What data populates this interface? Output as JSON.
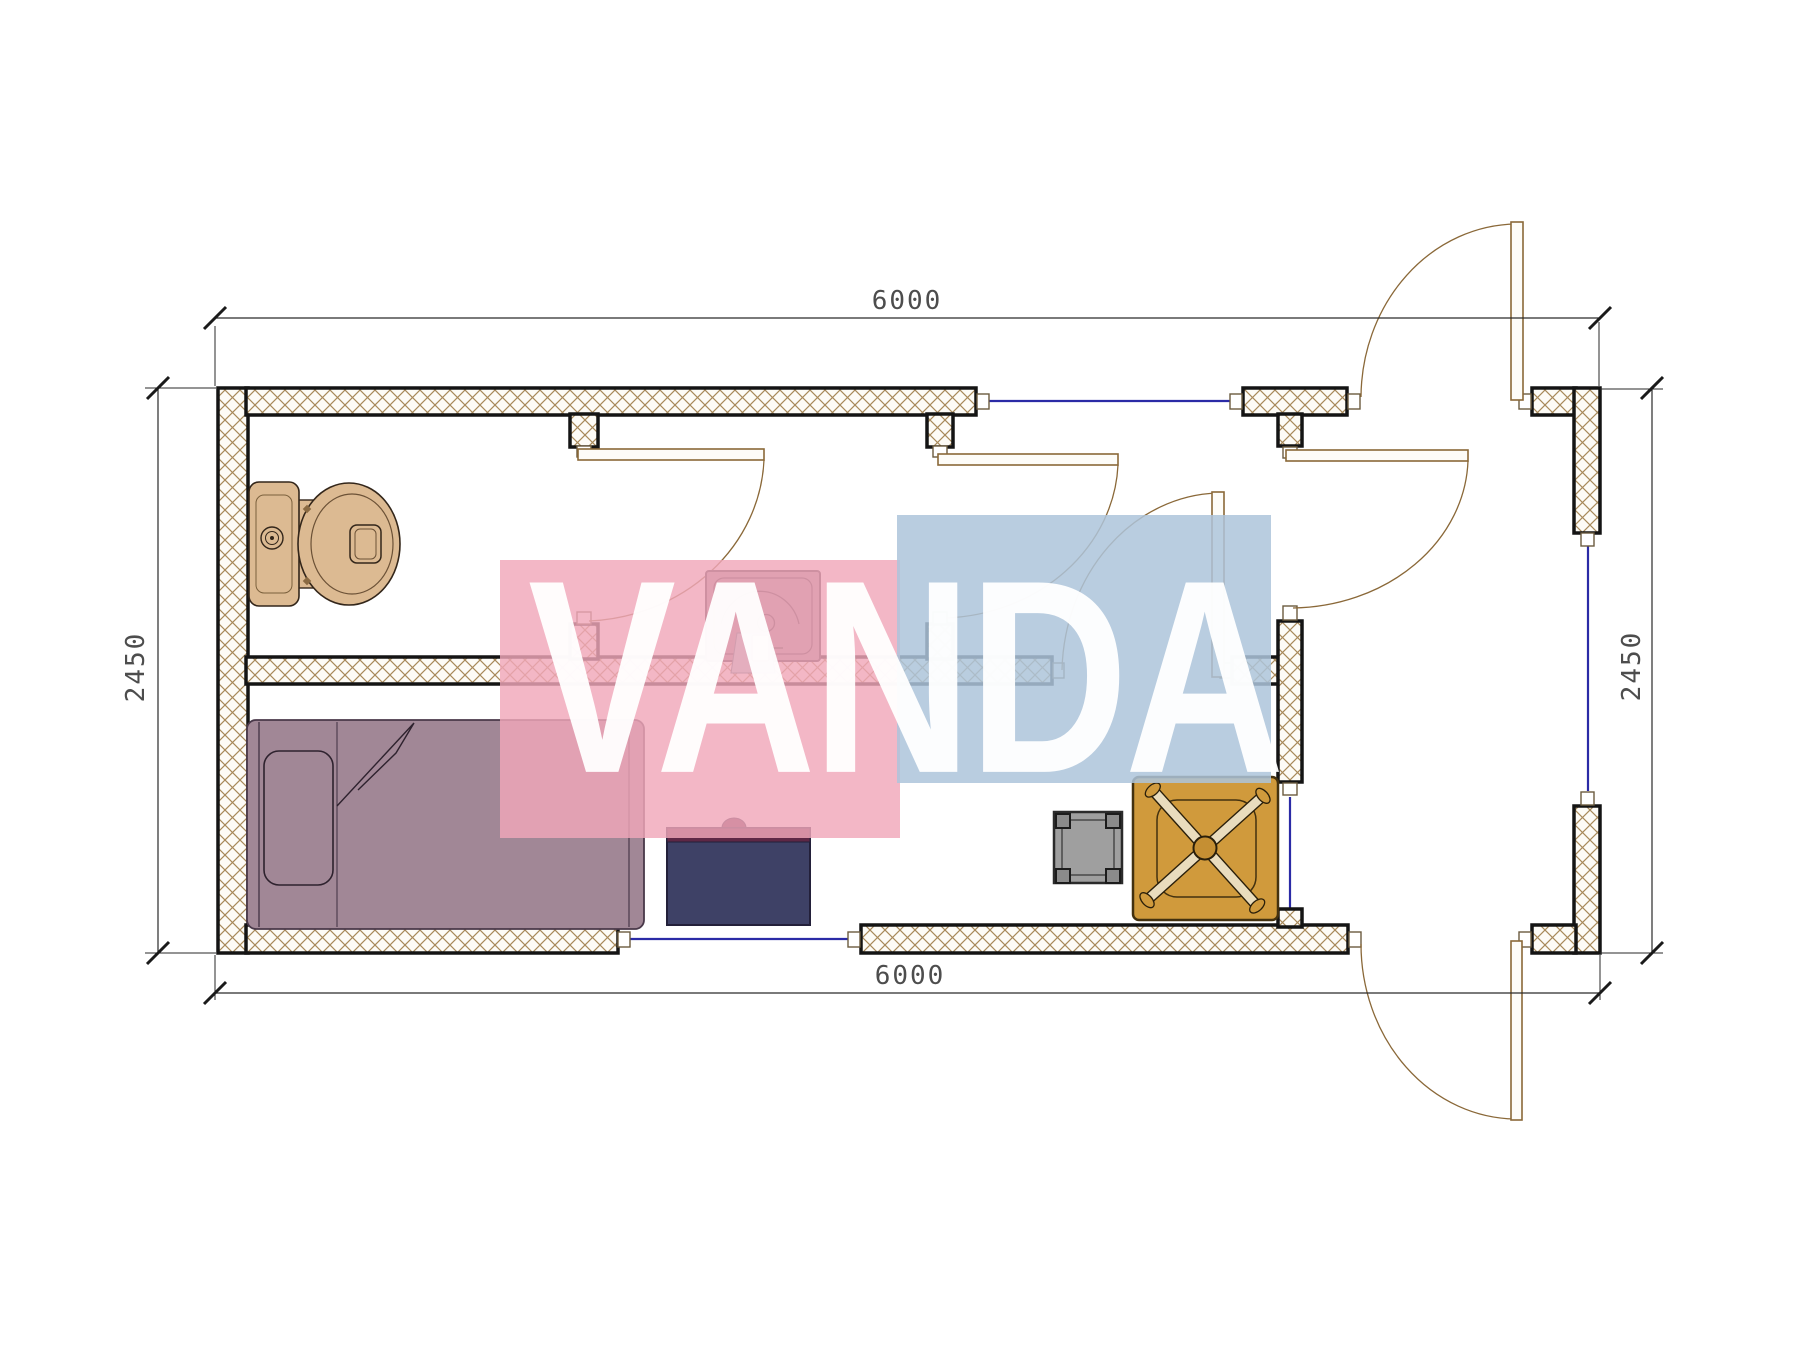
{
  "page": {
    "background": "#ffffff",
    "width": 1800,
    "height": 1350
  },
  "watermark": {
    "text": "VANDA",
    "pink_block_color": "#f0a7b9",
    "blue_block_color": "#adc4db",
    "letter_color": "#ffffff"
  },
  "dimensions": {
    "top_label": "6000",
    "bottom_label": "6000",
    "left_label": "2450",
    "right_label": "2450"
  },
  "plan": {
    "wall_hatch_color": "#a8895a",
    "wall_outline_color": "#141414",
    "window_color": "#2b2ba6",
    "door_color": "#8a6838",
    "dimension_line_color": "#2a2a2a",
    "furniture": {
      "toilet_color": "#dcba92",
      "sink_color": "#9c8391",
      "sink_towel_color": "#a9ced2",
      "bed_color": "#a18796",
      "desk_color": "#3e4166",
      "desk_accent_color": "#5e2745",
      "stool_color": "#9f9f9f",
      "chair_color": "#d09a3c"
    },
    "furniture_items": [
      "toilet",
      "sink",
      "single-bed",
      "desk",
      "stool",
      "office-chair"
    ],
    "door_count": 6,
    "window_count": 4
  }
}
